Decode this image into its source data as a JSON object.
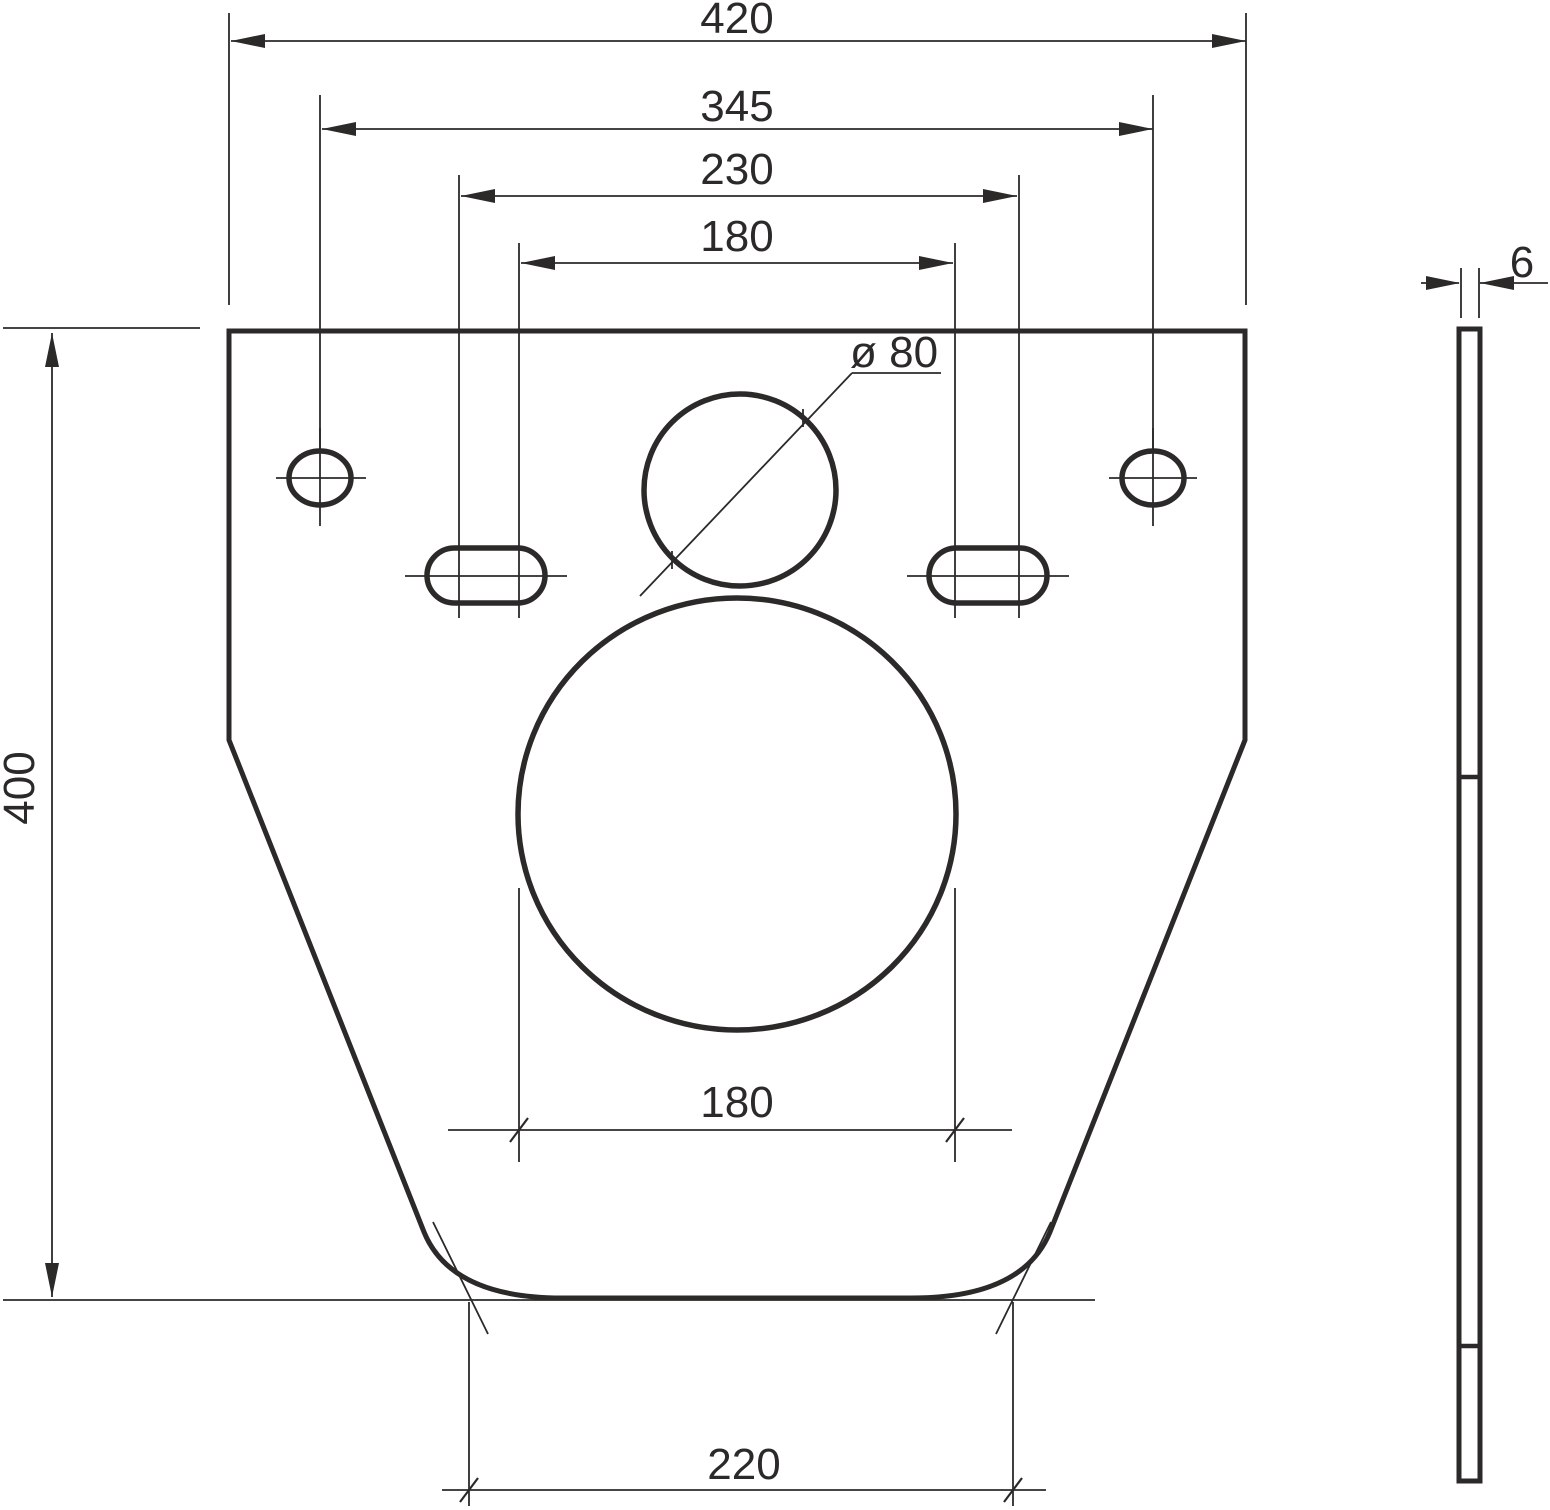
{
  "colors": {
    "line": "#2b2a29",
    "background": "#ffffff"
  },
  "front_view": {
    "dim_overall_width": "420",
    "dim_hole_spacing": "345",
    "dim_slot_spacing_outer": "230",
    "dim_slot_spacing_inner": "180",
    "dim_overall_height": "400",
    "dim_top_opening_diameter": "ø 80",
    "dim_main_opening_width": "180",
    "dim_bottom_width": "220"
  },
  "side_view": {
    "dim_thickness": "6"
  }
}
